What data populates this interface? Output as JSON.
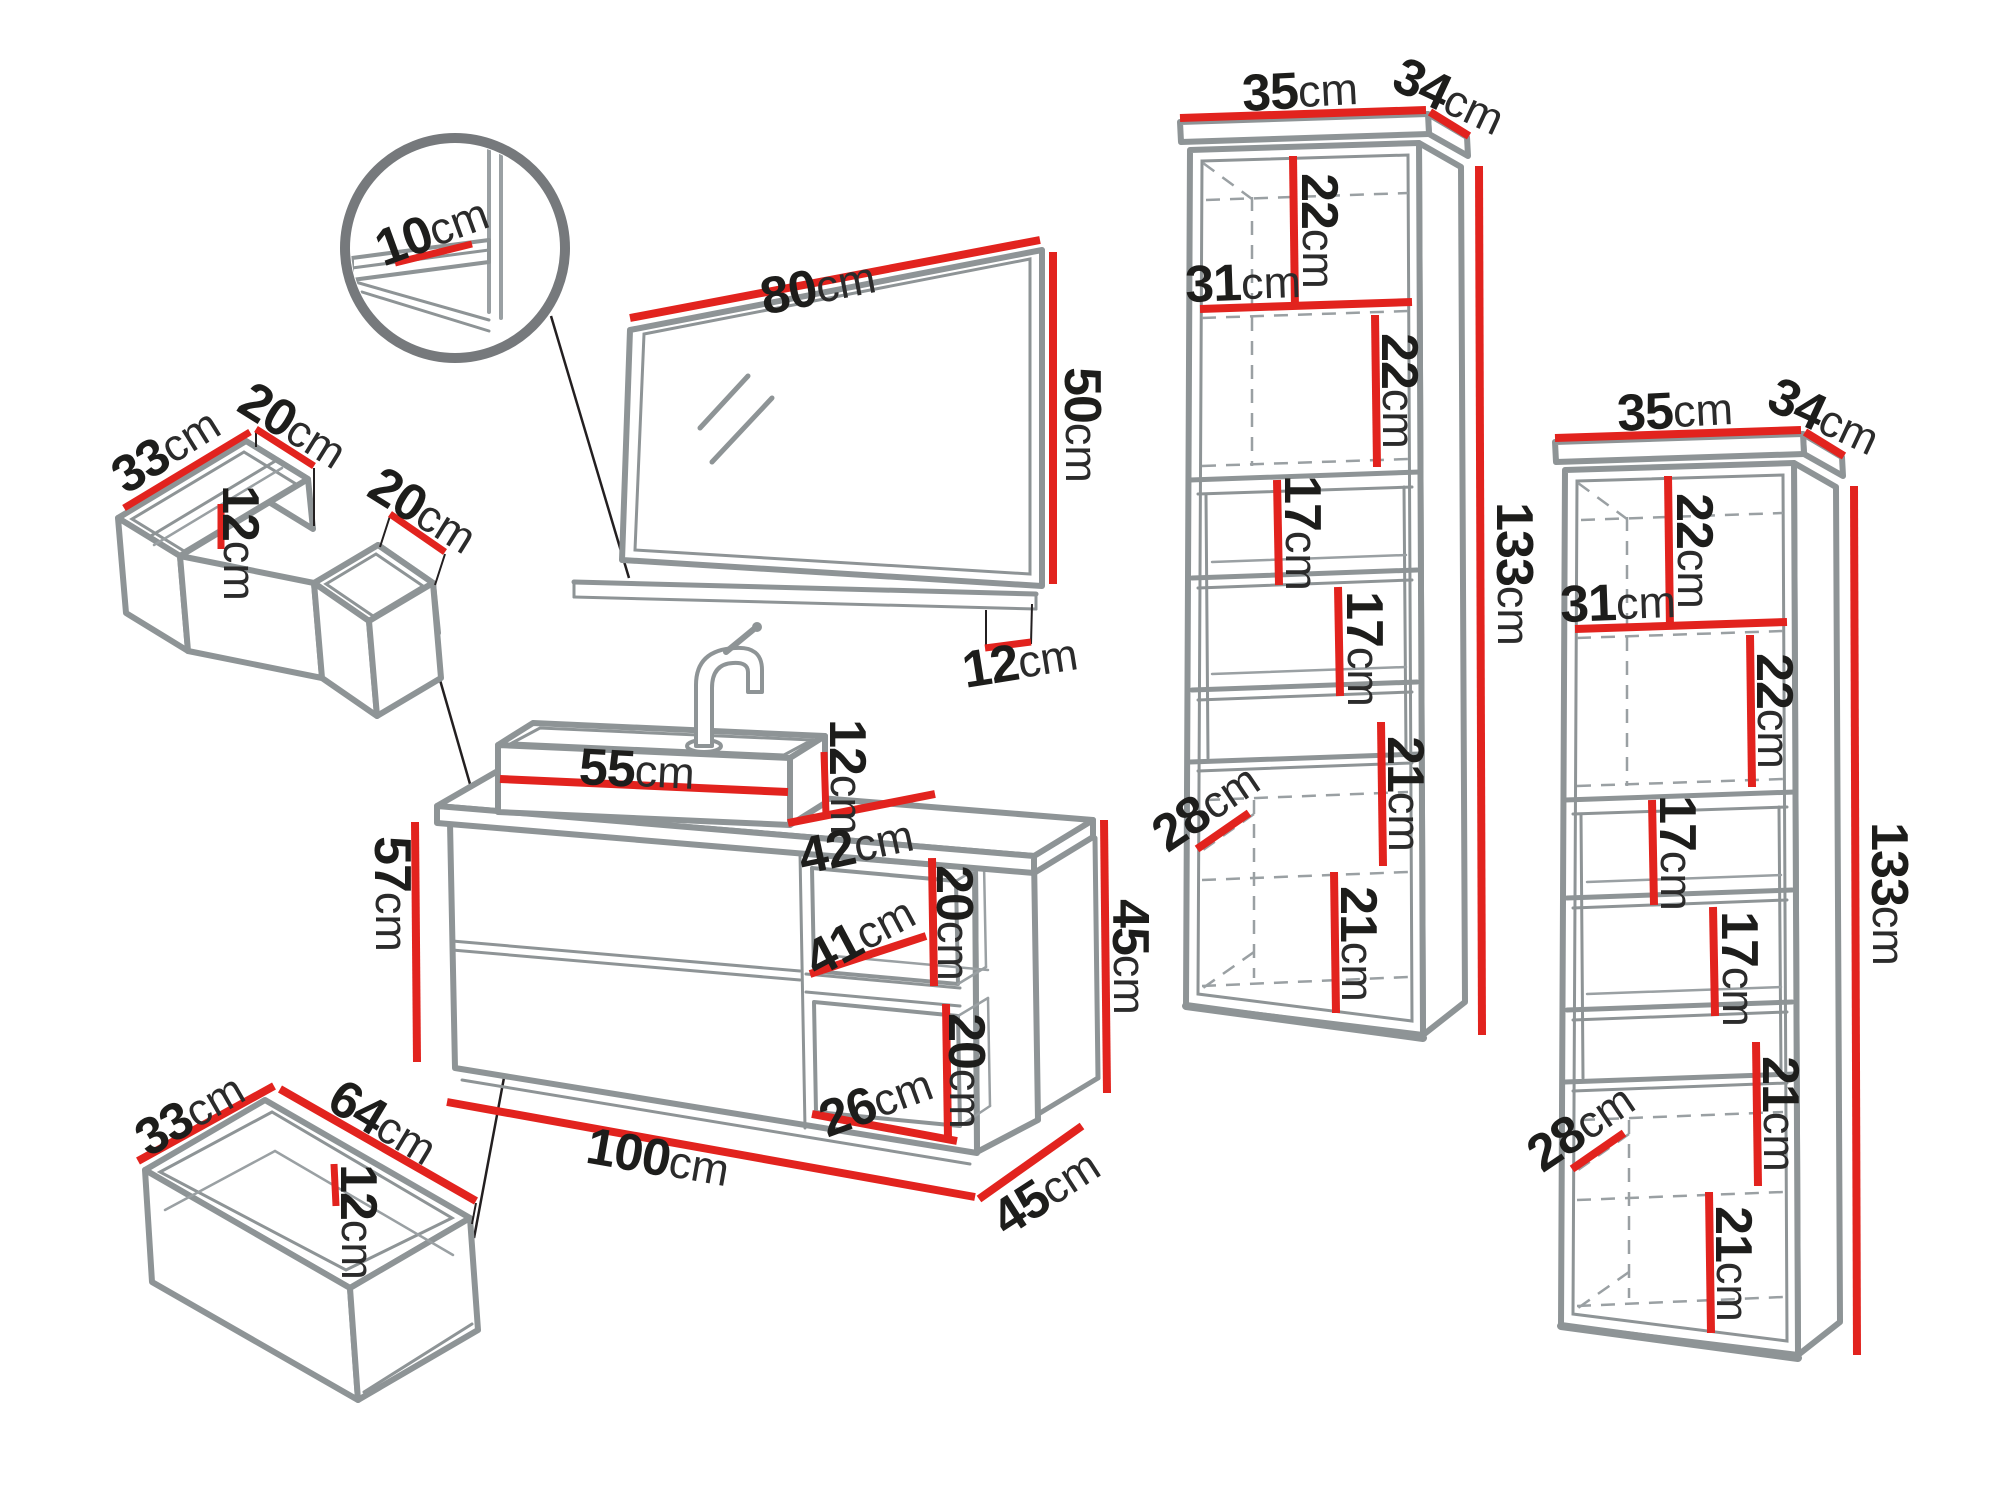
{
  "units": "cm",
  "colors": {
    "dimension_red": "#e2231e",
    "outline_gray": "#8e9496",
    "callout_black": "#231f20",
    "text_dark": "#1d1d1b"
  },
  "magnifier_detail": {
    "shelf_thickness": "10"
  },
  "mirror": {
    "width": "80",
    "height": "50",
    "shelf_depth": "12"
  },
  "drawer_organizer": {
    "depth": "33",
    "left_compartment_width": "20",
    "inner_height": "12",
    "right_compartment_width": "20"
  },
  "washbasin": {
    "width": "55",
    "height": "12",
    "depth": "42"
  },
  "vanity_cabinet": {
    "body_height": "57",
    "width": "100",
    "depth": "45",
    "niche_shelf_depth": "41",
    "niche_upper_height": "20",
    "niche_lower_height": "20",
    "niche_width": "26",
    "niche_height": "45"
  },
  "drawer_box": {
    "depth": "33",
    "width": "64",
    "height": "12"
  },
  "tall_cabinet_left": {
    "top_width": "35",
    "top_depth": "34",
    "compartment1_height": "22",
    "compartment1_width": "31",
    "compartment2_height": "22",
    "shelf_space1_height": "17",
    "shelf_space2_height": "17",
    "bottom_depth": "28",
    "compartment3_height": "21",
    "compartment4_height": "21",
    "total_height": "133"
  },
  "tall_cabinet_right": {
    "top_width": "35",
    "top_depth": "34",
    "compartment1_height": "22",
    "compartment1_width": "31",
    "compartment2_height": "22",
    "shelf_space1_height": "17",
    "shelf_space2_height": "17",
    "bottom_depth": "28",
    "compartment3_height": "21",
    "compartment4_height": "21",
    "total_height": "133"
  }
}
